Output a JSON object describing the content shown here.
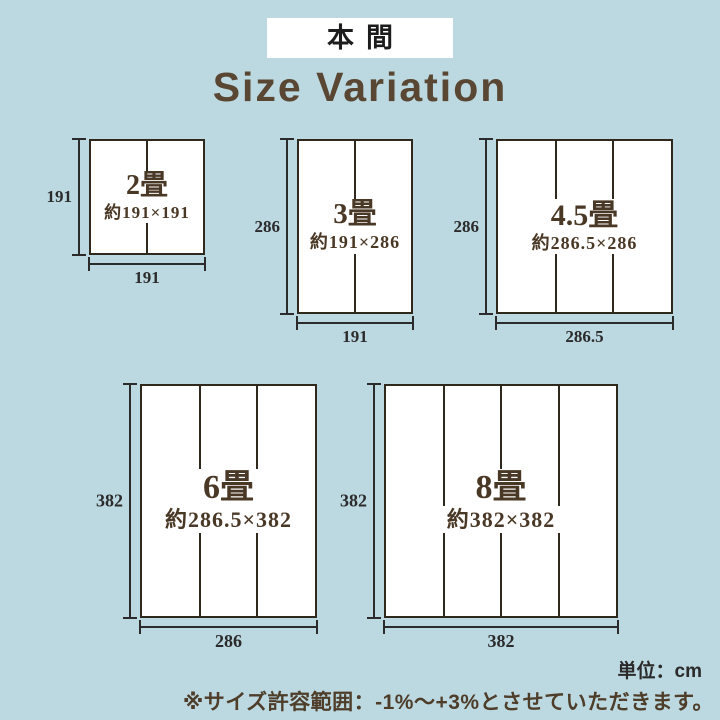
{
  "badge": {
    "label": "本間"
  },
  "title": {
    "text": "Size Variation"
  },
  "notes": {
    "unit": "単位：cm",
    "tolerance": "※サイズ許容範囲：-1%〜+3%とさせていただきます。"
  },
  "colors": {
    "background": "#bcd9e2",
    "panel": "#ffffff",
    "rect_line": "#2e281d",
    "dim_line": "#2b2b2b",
    "label_brown": "#4a3826",
    "title_brown": "#594733"
  },
  "sizes": [
    {
      "name": "2畳",
      "approx": "約191×191",
      "width_cm": "191",
      "height_cm": "191",
      "panels": 2
    },
    {
      "name": "3畳",
      "approx": "約191×286",
      "width_cm": "191",
      "height_cm": "286",
      "panels": 2
    },
    {
      "name": "4.5畳",
      "approx": "約286.5×286",
      "width_cm": "286.5",
      "height_cm": "286",
      "panels": 3
    },
    {
      "name": "6畳",
      "approx": "約286.5×382",
      "width_cm": "286",
      "height_cm": "382",
      "panels": 3
    },
    {
      "name": "8畳",
      "approx": "約382×382",
      "width_cm": "382",
      "height_cm": "382",
      "panels": 4
    }
  ]
}
